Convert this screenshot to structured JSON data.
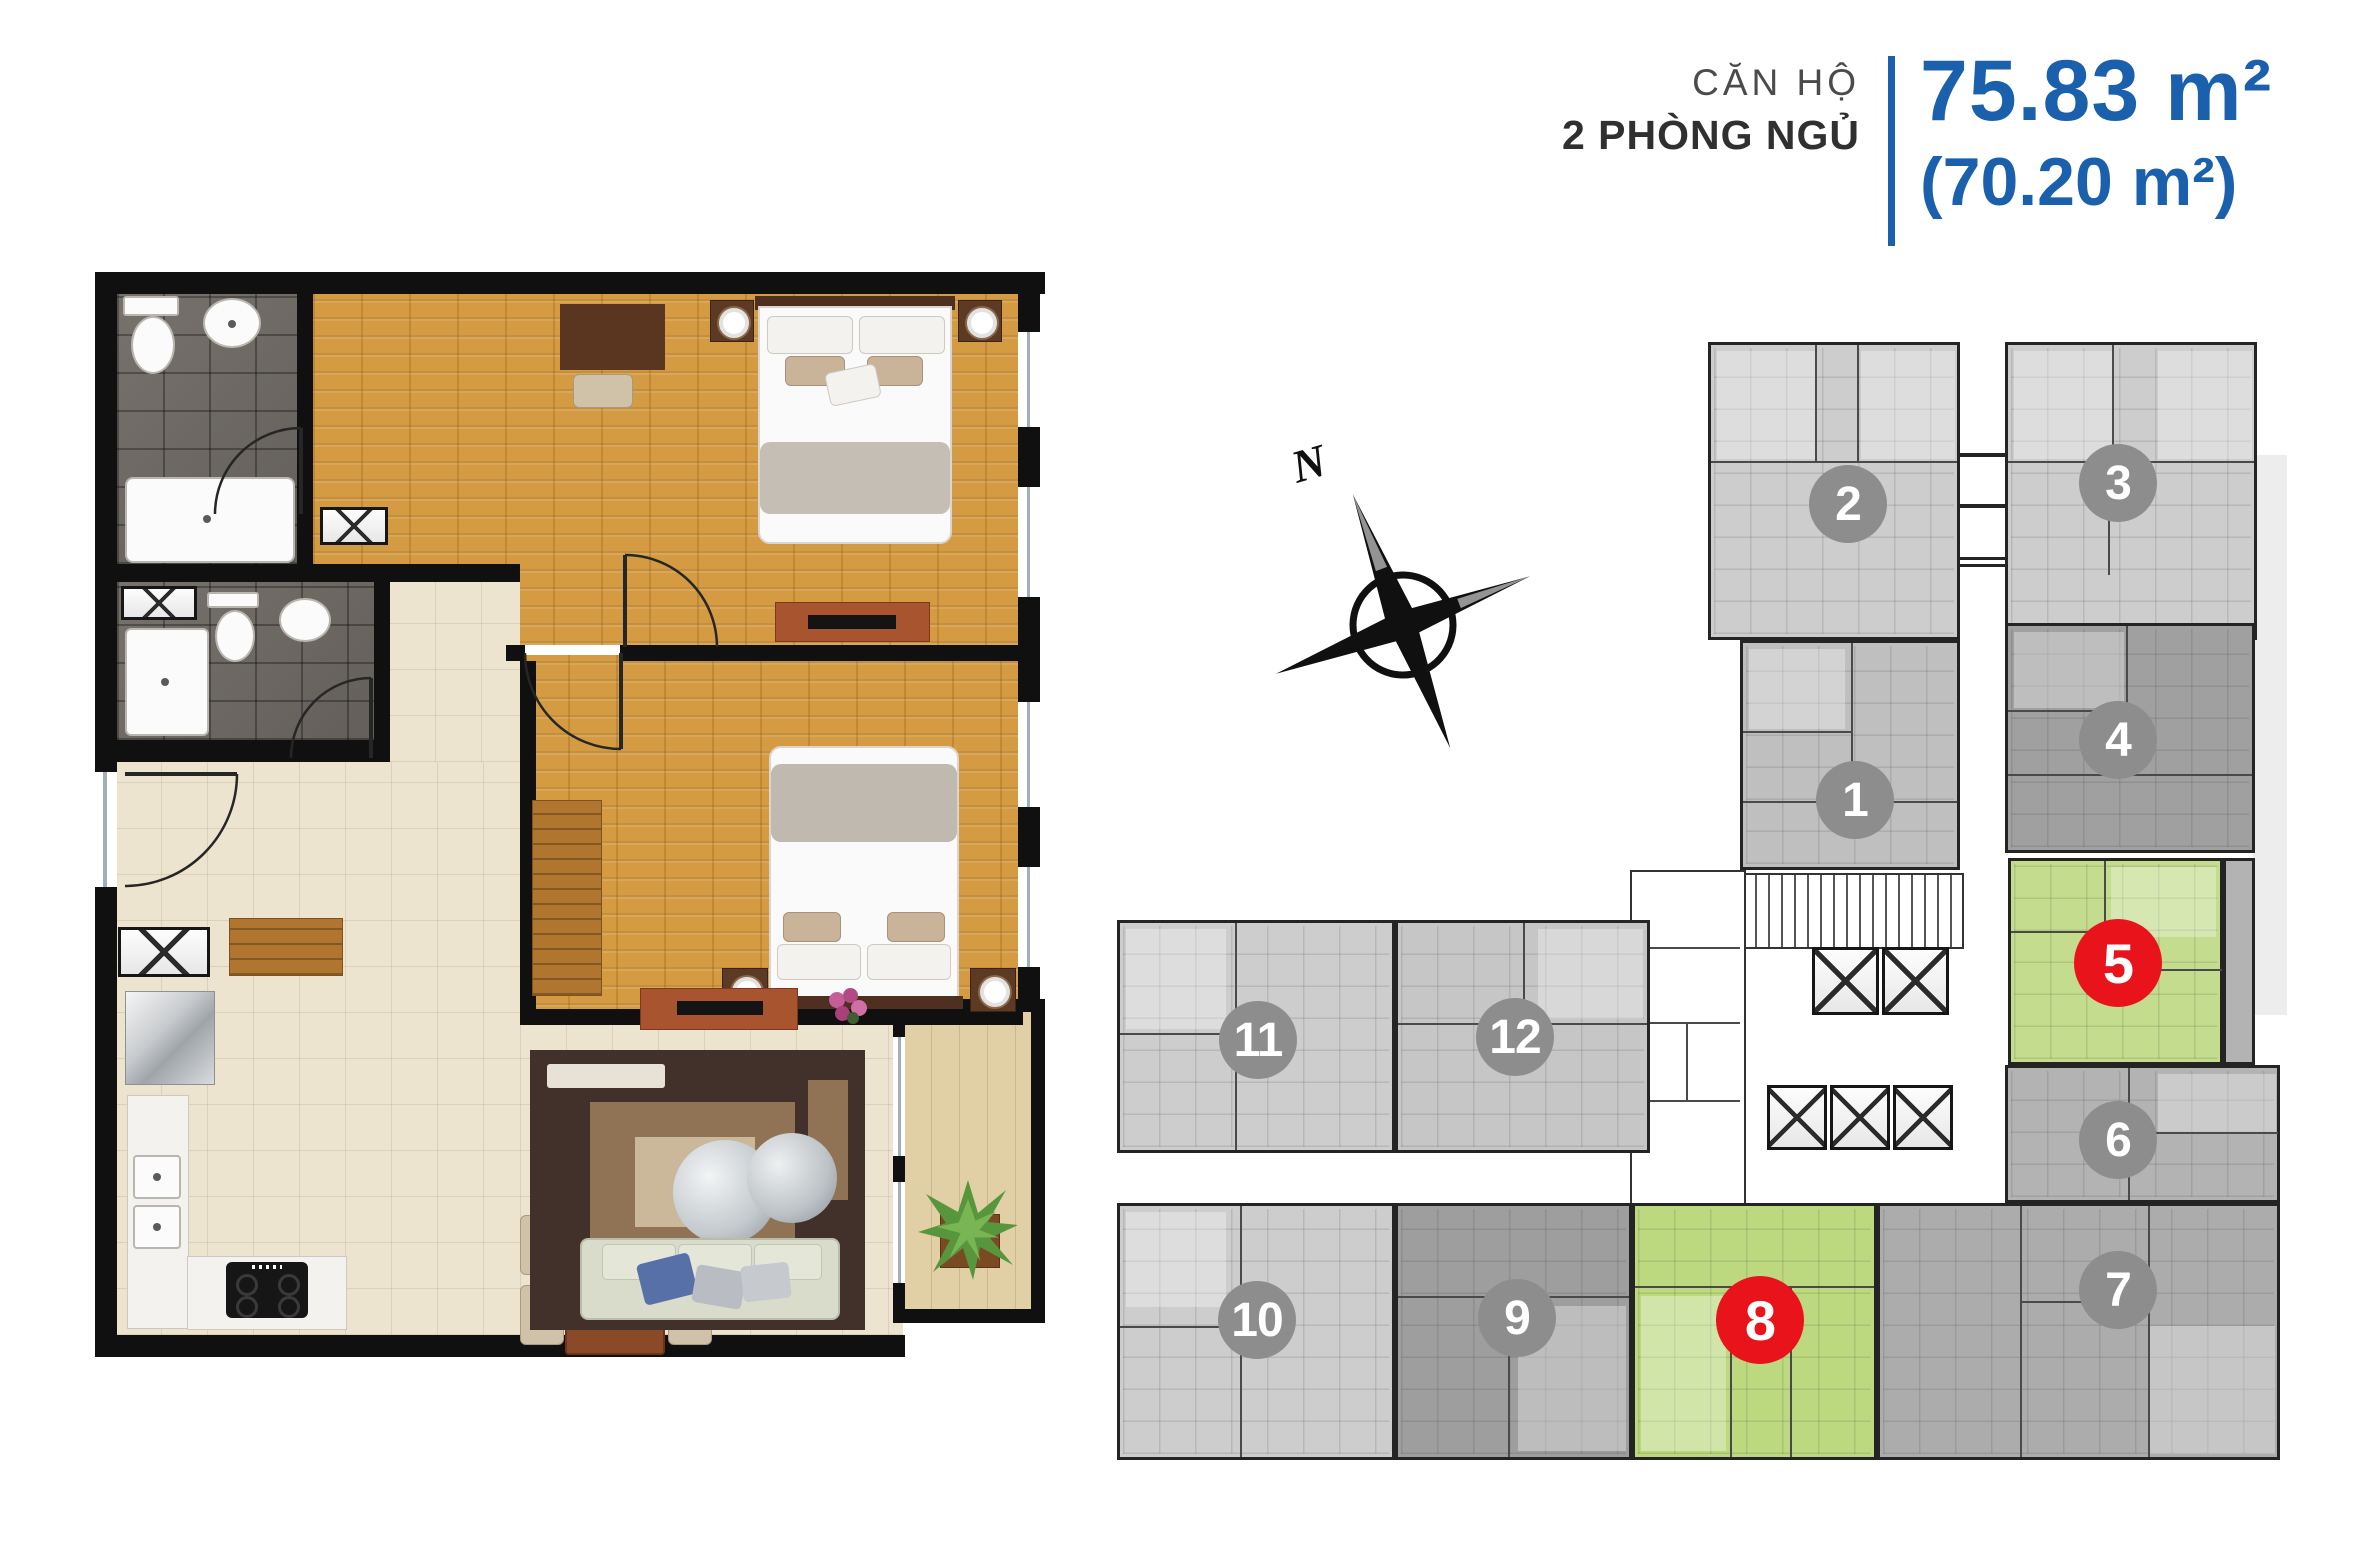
{
  "header": {
    "category_label": "CĂN HỘ",
    "type_label": "2 PHÒNG NGỦ",
    "area_main": "75.83 m²",
    "area_secondary": "(70.20 m²)"
  },
  "compass": {
    "north_label": "N"
  },
  "floorplate": {
    "units": [
      {
        "number": "1",
        "highlighted": false
      },
      {
        "number": "2",
        "highlighted": false
      },
      {
        "number": "3",
        "highlighted": false
      },
      {
        "number": "4",
        "highlighted": false
      },
      {
        "number": "5",
        "highlighted": true
      },
      {
        "number": "6",
        "highlighted": false
      },
      {
        "number": "7",
        "highlighted": false
      },
      {
        "number": "8",
        "highlighted": true
      },
      {
        "number": "9",
        "highlighted": false
      },
      {
        "number": "10",
        "highlighted": false
      },
      {
        "number": "11",
        "highlighted": false
      },
      {
        "number": "12",
        "highlighted": false
      }
    ],
    "selected_units": [
      "5",
      "8"
    ]
  },
  "colors": {
    "accent_blue": "#1a60ad",
    "highlight_green": "#c3dc8d",
    "badge_red": "#e9141b",
    "badge_gray": "#8d8d8d",
    "wall_black": "#101010",
    "wood_floor": "#d49b43",
    "bath_tile": "#6e6963",
    "tile_beige": "#ede4d0",
    "balcony_sand": "#e1d0a6"
  }
}
